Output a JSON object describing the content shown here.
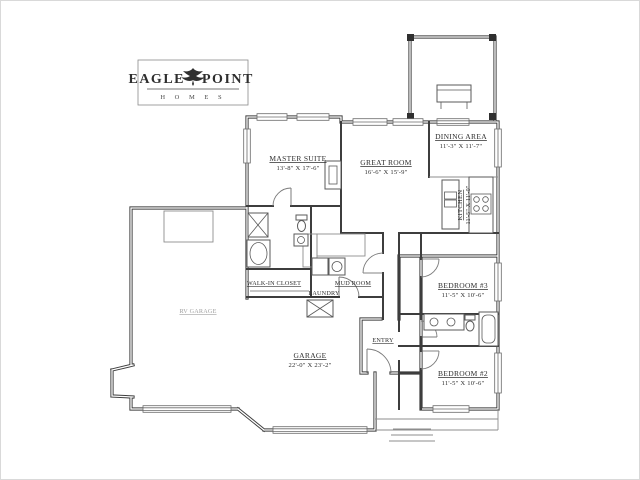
{
  "logo": {
    "brand_left": "EAGLE",
    "brand_right": "POINT",
    "sub": "H O M E S",
    "icon": "eagle-bird-icon"
  },
  "rooms": {
    "master_suite": {
      "name": "MASTER SUITE",
      "dims": "13'-8\" X 17'-6\""
    },
    "great_room": {
      "name": "GREAT ROOM",
      "dims": "16'-6\" X 15'-9\""
    },
    "dining_area": {
      "name": "DINING AREA",
      "dims": "11'-3\" X 11'-7\""
    },
    "kitchen": {
      "name": "KITCHEN",
      "dims": "11'-5\" X 11'-0\""
    },
    "bedroom_3": {
      "name": "BEDROOM #3",
      "dims": "11'-5\" X 10'-6\""
    },
    "bedroom_2": {
      "name": "BEDROOM #2",
      "dims": "11'-5\" X 10'-6\""
    },
    "garage": {
      "name": "GARAGE",
      "dims": "22'-0\" X 23'-2\""
    },
    "rv_garage": {
      "name": "RV GARAGE"
    },
    "entry": {
      "name": "ENTRY"
    },
    "mud_room": {
      "name": "MUD ROOM"
    },
    "laundry": {
      "name": "LAUNDRY"
    },
    "walk_in_closet": {
      "name": "WALK-IN CLOSET"
    }
  },
  "colors": {
    "wall": "#3d3d3d",
    "thin_line": "#8d8d8d",
    "text": "#2e2e2e",
    "faint_label": "#a0a0a0",
    "background": "#ffffff"
  }
}
